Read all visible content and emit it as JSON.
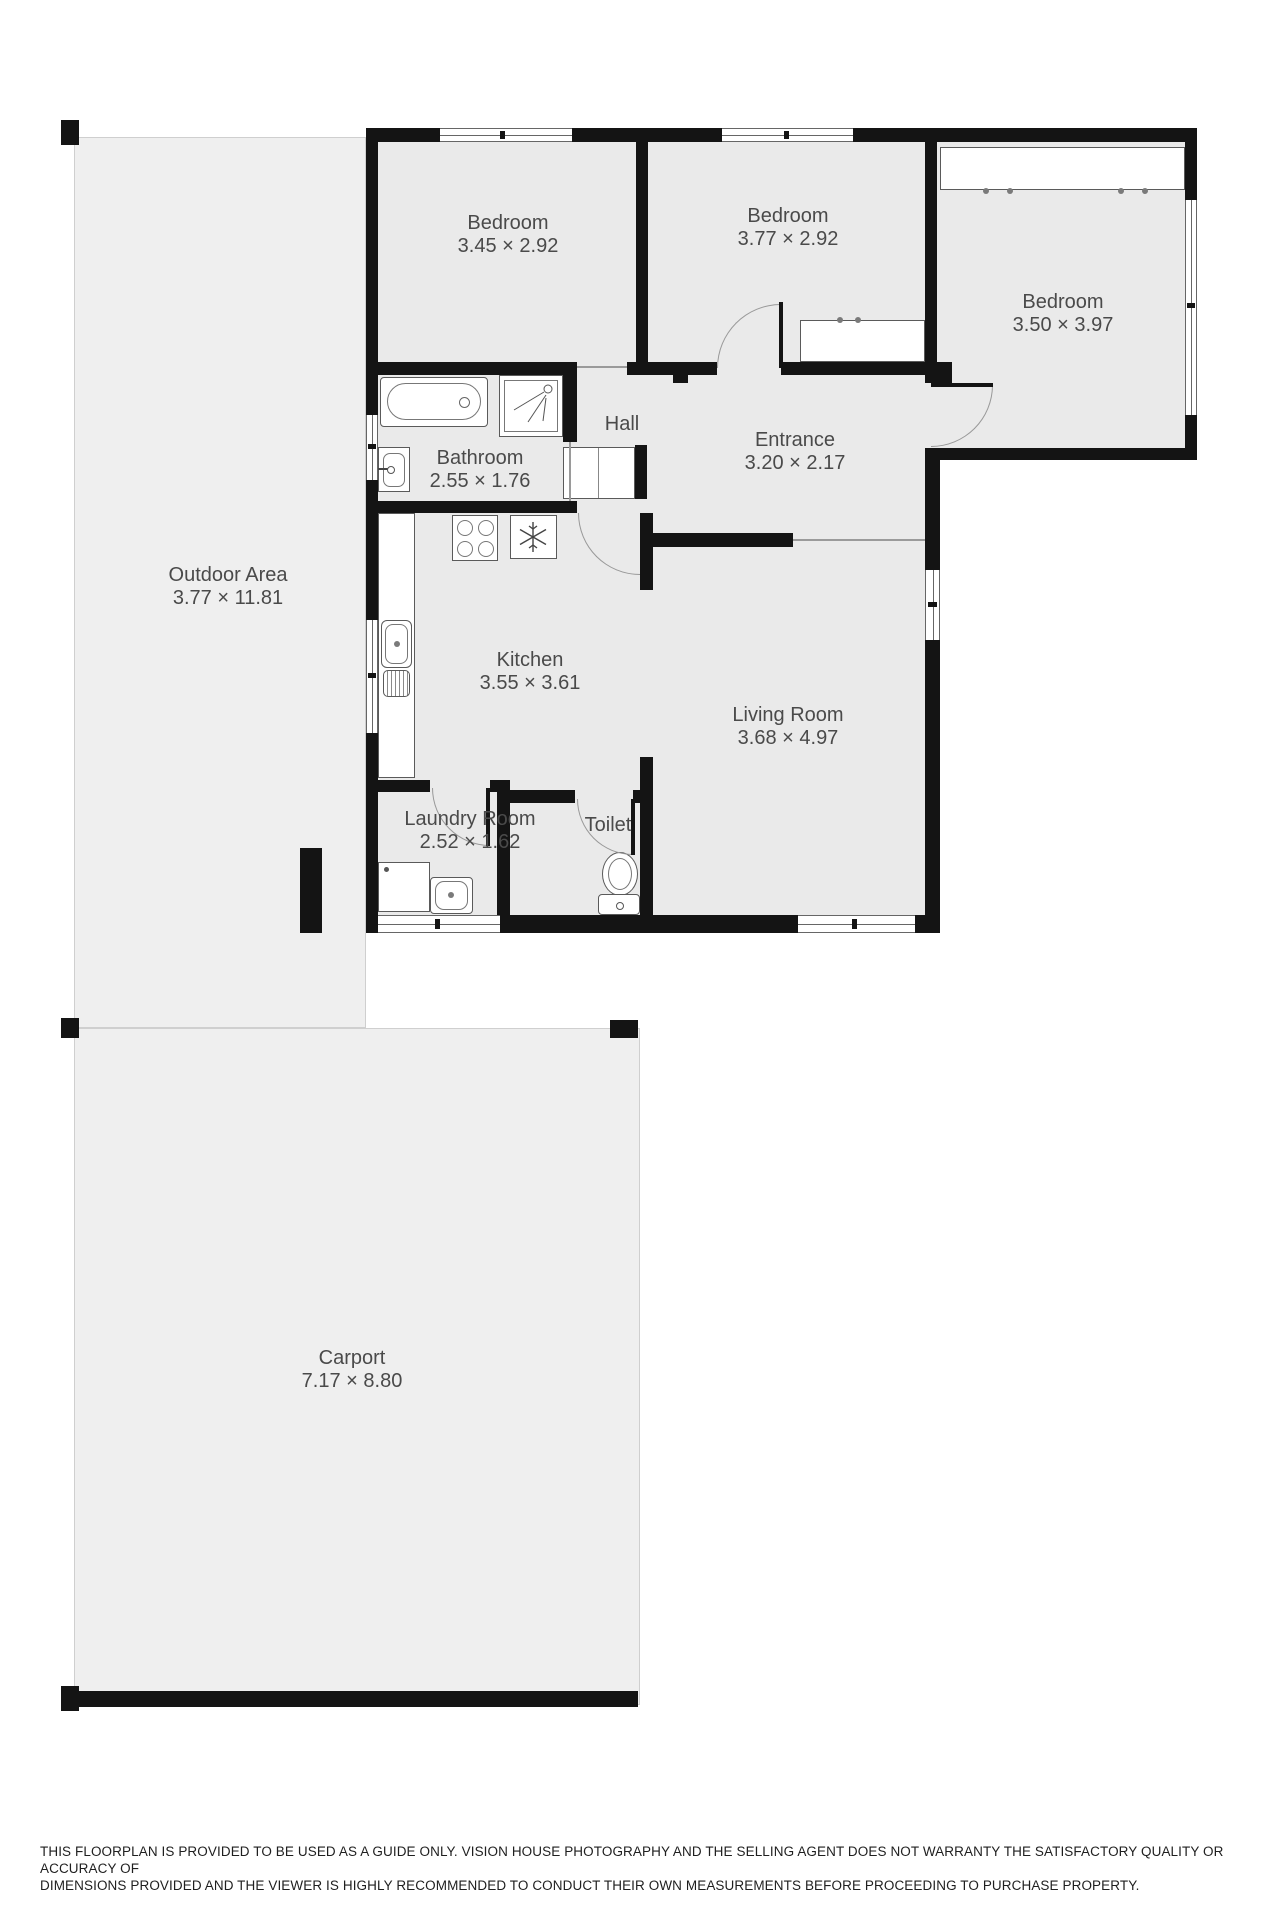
{
  "page": {
    "type": "floorplan"
  },
  "colors": {
    "wall": "#141414",
    "room_floor": "#eaeaea",
    "outdoor_floor": "#efefef",
    "fixture_stroke": "#5a5a5a",
    "label_text": "#4a4a4a",
    "door_arc": "#999999"
  },
  "rooms": [
    {
      "name": "Bedroom",
      "dims": "3.45 × 2.92"
    },
    {
      "name": "Bedroom",
      "dims": "3.77 × 2.92"
    },
    {
      "name": "Bedroom",
      "dims": "3.50 × 3.97"
    },
    {
      "name": "Hall",
      "dims": ""
    },
    {
      "name": "Entrance",
      "dims": "3.20 × 2.17"
    },
    {
      "name": "Bathroom",
      "dims": "2.55 × 1.76"
    },
    {
      "name": "Kitchen",
      "dims": "3.55 × 3.61"
    },
    {
      "name": "Living Room",
      "dims": "3.68 × 4.97"
    },
    {
      "name": "Laundry Room",
      "dims": "2.52 × 1.62"
    },
    {
      "name": "Toilet",
      "dims": ""
    },
    {
      "name": "Outdoor Area",
      "dims": "3.77 × 11.81"
    },
    {
      "name": "Carport",
      "dims": "7.17 × 8.80"
    }
  ],
  "disclaimer": {
    "line1": "THIS FLOORPLAN IS PROVIDED TO BE USED AS A GUIDE ONLY. VISION HOUSE PHOTOGRAPHY AND THE SELLING AGENT DOES NOT WARRANTY THE SATISFACTORY QUALITY OR ACCURACY OF",
    "line2": "DIMENSIONS PROVIDED AND THE VIEWER IS HIGHLY RECOMMENDED TO CONDUCT THEIR OWN MEASUREMENTS BEFORE PROCEEDING TO PURCHASE PROPERTY."
  }
}
